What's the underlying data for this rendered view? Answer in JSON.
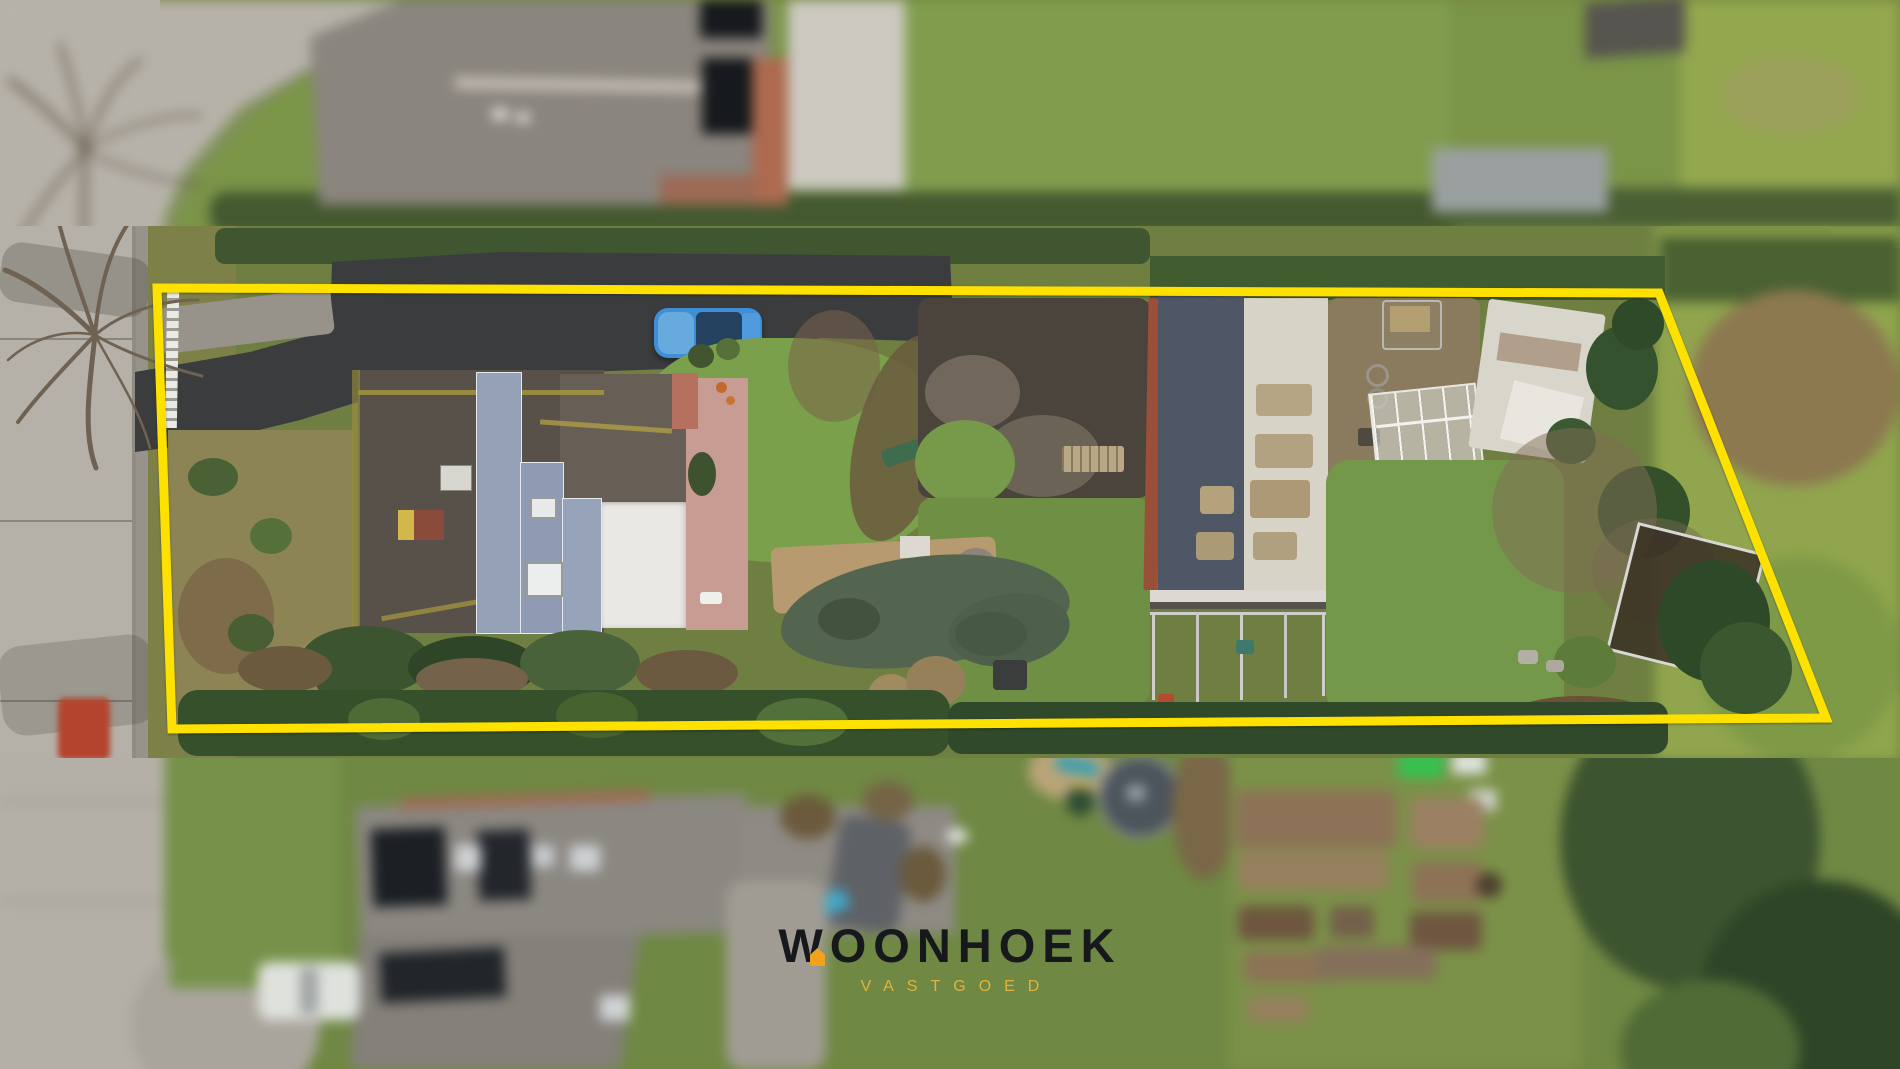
{
  "photo": {
    "kind": "aerial-drone-photo",
    "scene": "elongated residential plot highlighted with a yellow boundary, street on the left, neighbouring gardens blurred above and below",
    "elements": [
      "street",
      "grass-verge",
      "bare-trees",
      "driveway",
      "parked-blue-car",
      "main-house-solar-roof",
      "flat-roof-extension",
      "terrace",
      "garden-lawn",
      "covered-pond",
      "barn-solar-roof",
      "corrugated-roof",
      "greenhouse",
      "wild-garden",
      "collapsed-structure",
      "neighbour-house-top",
      "neighbour-house-bottom",
      "white-car",
      "trampoline",
      "vegetable-garden"
    ]
  },
  "boundary": {
    "color": "#FFE100",
    "points": "157,288 1659,293 1826,718 172,729"
  },
  "watermark": {
    "brand": "WOONHOEK",
    "tagline": "VASTGOED"
  },
  "colors": {
    "boundary-yellow": "#FFE100",
    "brand-ink": "#17181C",
    "brand-gold": "#E2B23C",
    "brand-orange": "#F0A21C"
  }
}
